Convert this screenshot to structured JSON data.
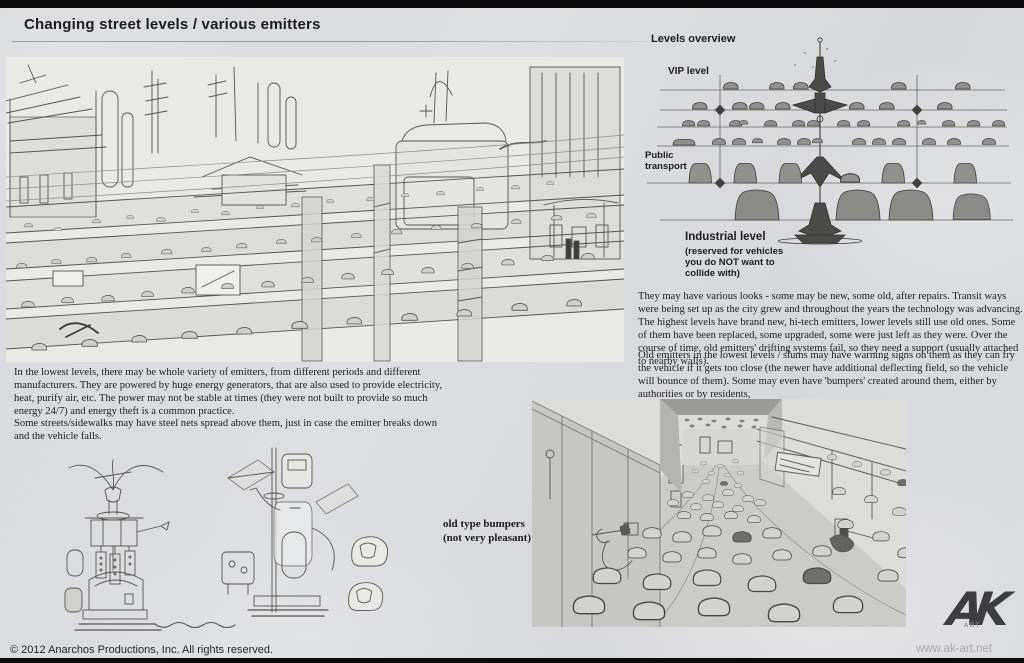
{
  "header": {
    "title": "Changing street levels / various emitters"
  },
  "levels_overview": {
    "heading": "Levels overview",
    "levels": [
      {
        "label": "VIP level"
      },
      {
        "label": "Public transport"
      },
      {
        "label": "Industrial level",
        "note": "(reserved for vehicles you do NOT want to collide with)"
      }
    ]
  },
  "text_blocks": {
    "emitters_variety": "In the lowest levels, there may be whole variety of emitters, from different periods and different manufacturers. They are powered by huge energy generators, that are also used to provide electricity, heat, purify air, etc. The power may not be stable at times (they were not built to provide so much energy 24/7) and energy theft is a common practice.",
    "steel_nets": "Some streets/sidewalks may have steel nets spread above them, just in case the emitter breaks down and the vehicle falls.",
    "various_looks": "They may have various looks - some may be new, some old, after repairs. Transit ways were being set up as the city grew and throughout the years the technology was advancing. The highest levels have brand new, hi-tech emitters, lower levels still use old ones. Some of them have been replaced, some upgraded, some were just left as they were. Over the course of time, old emitters' drifting systems fail, so they need a support (usually attached to nearby walls).",
    "old_emitters": "Old emitters in the lowest levels / slums may have warning signs on them as they can fry the vehicle if it gets too close (the newer have additional deflecting field, so the vehicle will bounce of them). Some may even have 'bumpers' created around them, either by authorities or by residents,"
  },
  "captions": {
    "bumpers_label": "old type bumpers",
    "bumpers_note": "(not very pleasant)"
  },
  "footer": {
    "copyright": "© 2012 Anarchos Productions, Inc. All rights reserved.",
    "website": "www.ak-art.net"
  },
  "logo": {
    "text": "AK",
    "sub": "ART"
  },
  "colors": {
    "page_bg": "#d9dbde",
    "bar": "#0b0b0c",
    "ink": "#1b1b1d",
    "pencil": "#55554f",
    "diagram_blob": "#90918d",
    "logo": "#3c3d40"
  }
}
